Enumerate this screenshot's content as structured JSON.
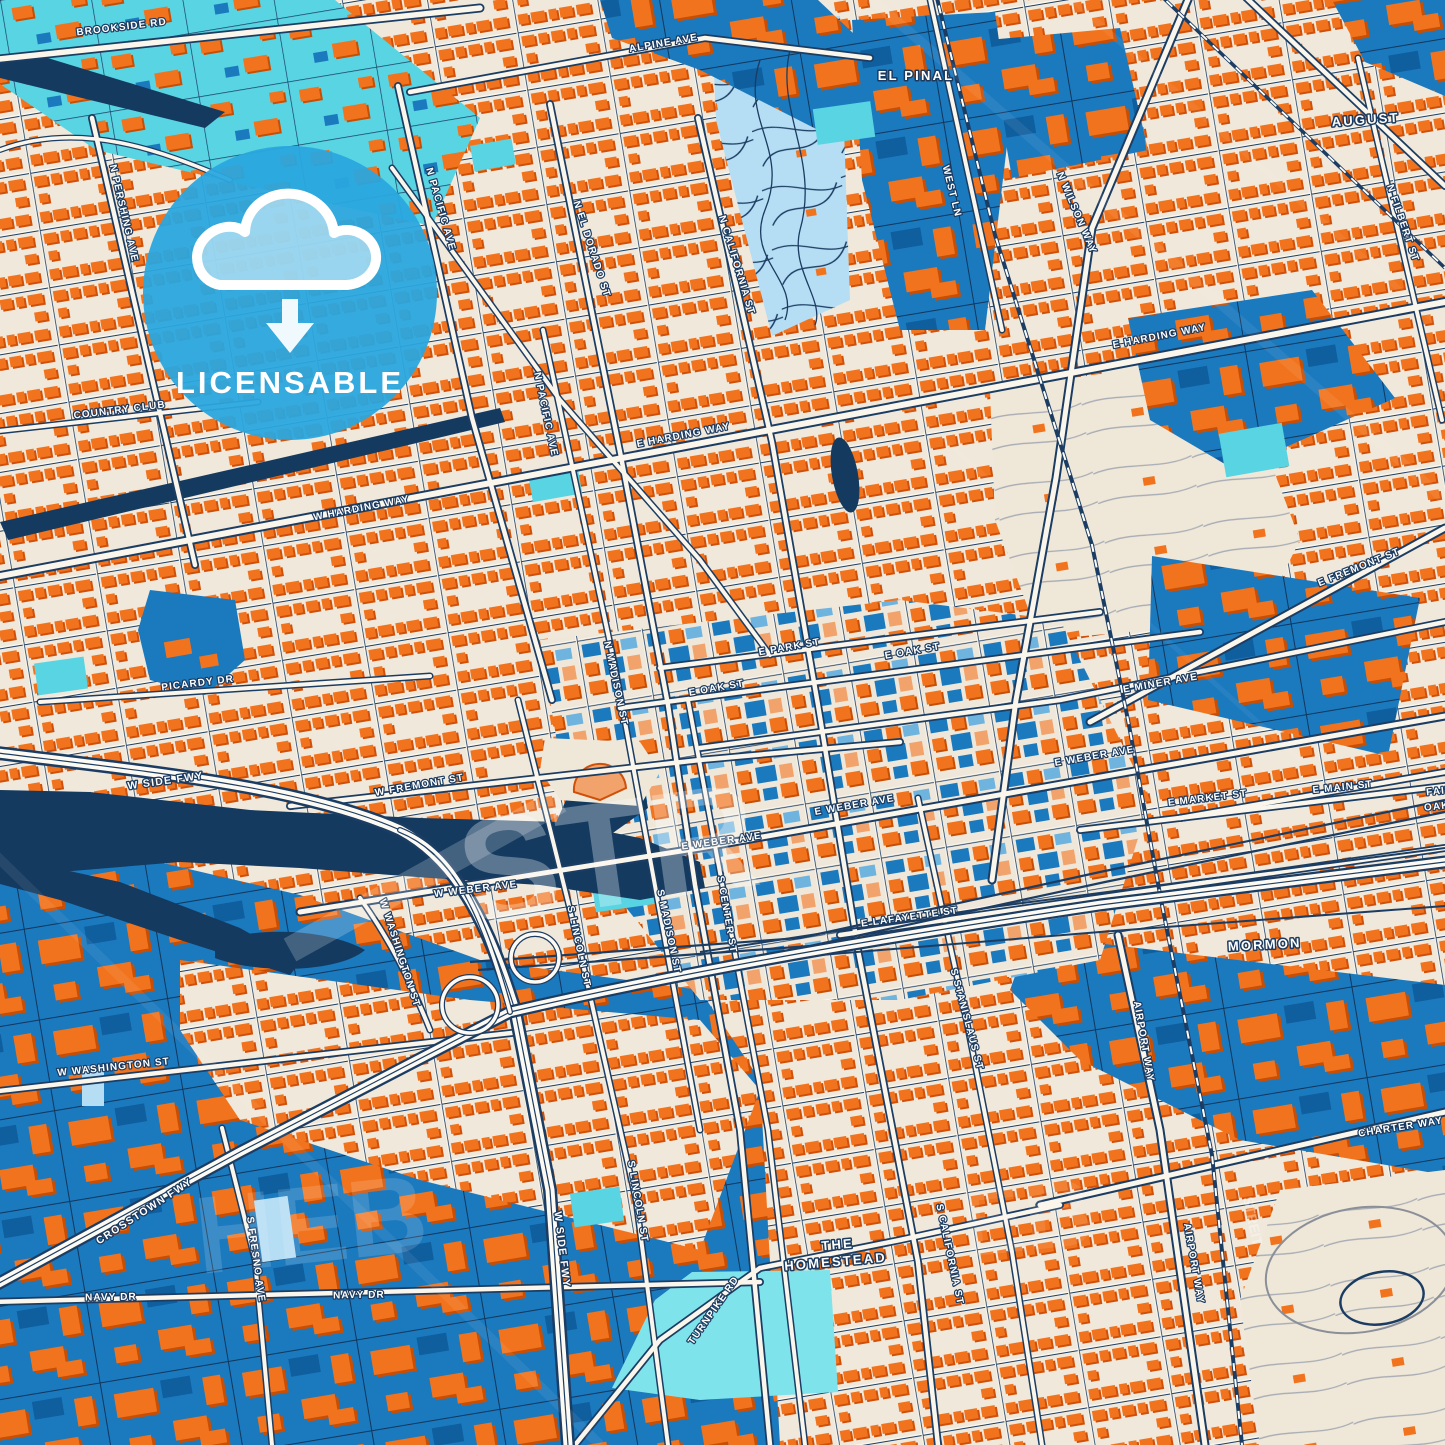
{
  "map": {
    "type": "stylized-city-map-poster",
    "city_hint": "Downtown street map with freeway, channel and rail yards",
    "badge": {
      "label": "LICENSABLE",
      "icon": "cloud-download-icon",
      "color": "#2AA7DE"
    },
    "colors": {
      "land": "#F0E8DA",
      "building_orange": "#F2731D",
      "building_shadow": "#D0500A",
      "building_salmon": "#F2A36B",
      "zone_blue": "#1B79BE",
      "zone_blue_dark": "#0F5E9E",
      "water_navy": "#143A60",
      "street_casing": "#1C3D63",
      "street_fill": "#FBF6EC",
      "park_cyan": "#58D4E2",
      "cemetery_lightblue": "#B5DDF4",
      "badge_blue": "#2AA7DE",
      "label_halo": "#1B3A5F",
      "label_fill": "#FFFFFF"
    },
    "labels": [
      {
        "text": "BROOKSIDE RD",
        "x": 122,
        "y": 30,
        "rot": -7,
        "kind": "street"
      },
      {
        "text": "ALPINE AVE",
        "x": 664,
        "y": 46,
        "rot": -10,
        "kind": "street"
      },
      {
        "text": "EL PINAL",
        "x": 916,
        "y": 80,
        "rot": 0,
        "kind": "locality"
      },
      {
        "text": "AUGUST",
        "x": 1366,
        "y": 124,
        "rot": -4,
        "kind": "locality"
      },
      {
        "text": "N PERSHING AVE",
        "x": 121,
        "y": 214,
        "rot": 77,
        "kind": "street"
      },
      {
        "text": "N PACIFIC AVE",
        "x": 438,
        "y": 210,
        "rot": 74,
        "kind": "street"
      },
      {
        "text": "N EL DORADO ST",
        "x": 589,
        "y": 250,
        "rot": 72,
        "kind": "street"
      },
      {
        "text": "N CALIFORNIA ST",
        "x": 734,
        "y": 266,
        "rot": 73,
        "kind": "street"
      },
      {
        "text": "WEST LN",
        "x": 949,
        "y": 192,
        "rot": 76,
        "kind": "street"
      },
      {
        "text": "N WILSON WAY",
        "x": 1074,
        "y": 214,
        "rot": 67,
        "kind": "street"
      },
      {
        "text": "N FILBERT ST",
        "x": 1400,
        "y": 224,
        "rot": 71,
        "kind": "street"
      },
      {
        "text": "E HARDING WAY",
        "x": 1160,
        "y": 339,
        "rot": -11,
        "kind": "street"
      },
      {
        "text": "COUNTRY CLUB",
        "x": 120,
        "y": 413,
        "rot": -7,
        "kind": "street"
      },
      {
        "text": "W HARDING WAY",
        "x": 362,
        "y": 511,
        "rot": -11,
        "kind": "street"
      },
      {
        "text": "E HARDING WAY",
        "x": 684,
        "y": 438,
        "rot": -11,
        "kind": "street"
      },
      {
        "text": "N PACIFIC AVE",
        "x": 543,
        "y": 415,
        "rot": 78,
        "kind": "street"
      },
      {
        "text": "E FREMONT ST",
        "x": 1360,
        "y": 570,
        "rot": -22,
        "kind": "street"
      },
      {
        "text": "E MINER AVE",
        "x": 1161,
        "y": 686,
        "rot": -10,
        "kind": "street"
      },
      {
        "text": "PICARDY DR",
        "x": 198,
        "y": 686,
        "rot": -7,
        "kind": "street"
      },
      {
        "text": "E PARK ST",
        "x": 790,
        "y": 650,
        "rot": -10,
        "kind": "street"
      },
      {
        "text": "E OAK ST",
        "x": 717,
        "y": 691,
        "rot": -10,
        "kind": "street"
      },
      {
        "text": "E OAK ST",
        "x": 913,
        "y": 654,
        "rot": -10,
        "kind": "street"
      },
      {
        "text": "N MADISON ST",
        "x": 613,
        "y": 684,
        "rot": 78,
        "kind": "street"
      },
      {
        "text": "W FREMONT ST",
        "x": 420,
        "y": 788,
        "rot": -10,
        "kind": "street"
      },
      {
        "text": "W SIDE FWY",
        "x": 166,
        "y": 784,
        "rot": -8,
        "kind": "fwy"
      },
      {
        "text": "E MAIN ST",
        "x": 1343,
        "y": 790,
        "rot": -6,
        "kind": "street"
      },
      {
        "text": "E MARKET ST",
        "x": 1208,
        "y": 801,
        "rot": -7,
        "kind": "street"
      },
      {
        "text": "FAIR",
        "x": 1440,
        "y": 794,
        "rot": -6,
        "kind": "street"
      },
      {
        "text": "OAKS",
        "x": 1441,
        "y": 809,
        "rot": -6,
        "kind": "street"
      },
      {
        "text": "E WEBER AVE",
        "x": 855,
        "y": 808,
        "rot": -10,
        "kind": "street"
      },
      {
        "text": "E WEBER AVE",
        "x": 1095,
        "y": 759,
        "rot": -10,
        "kind": "street"
      },
      {
        "text": "E WEBER AVE",
        "x": 722,
        "y": 844,
        "rot": -8,
        "kind": "street"
      },
      {
        "text": "W WEBER AVE",
        "x": 476,
        "y": 892,
        "rot": -7,
        "kind": "street"
      },
      {
        "text": "S LINCOLN ST",
        "x": 576,
        "y": 947,
        "rot": 78,
        "kind": "street"
      },
      {
        "text": "S MADISON ST",
        "x": 666,
        "y": 932,
        "rot": 78,
        "kind": "street"
      },
      {
        "text": "S CENTER ST",
        "x": 724,
        "y": 915,
        "rot": 80,
        "kind": "street"
      },
      {
        "text": "E LAFAYETTE ST",
        "x": 910,
        "y": 920,
        "rot": -8,
        "kind": "street"
      },
      {
        "text": "W WASHINGTON ST",
        "x": 397,
        "y": 954,
        "rot": 72,
        "kind": "street"
      },
      {
        "text": "S STANISLAUS ST",
        "x": 964,
        "y": 1020,
        "rot": 75,
        "kind": "street"
      },
      {
        "text": "W WASHINGTON ST",
        "x": 114,
        "y": 1070,
        "rot": -6,
        "kind": "street"
      },
      {
        "text": "MORMON",
        "x": 1265,
        "y": 949,
        "rot": -3,
        "kind": "locality"
      },
      {
        "text": "AIRPORT WAY",
        "x": 1141,
        "y": 1042,
        "rot": 80,
        "kind": "street"
      },
      {
        "text": "CHARTER WAY",
        "x": 1401,
        "y": 1130,
        "rot": -9,
        "kind": "street"
      },
      {
        "text": "CROSSTOWN FWY",
        "x": 146,
        "y": 1214,
        "rot": -33,
        "kind": "fwy"
      },
      {
        "text": "W SIDE FWY",
        "x": 559,
        "y": 1250,
        "rot": 83,
        "kind": "fwy"
      },
      {
        "text": "S LINCOLN ST",
        "x": 635,
        "y": 1202,
        "rot": 80,
        "kind": "street"
      },
      {
        "text": "S FRESNO AVE",
        "x": 253,
        "y": 1260,
        "rot": 82,
        "kind": "street"
      },
      {
        "text": "S CALIFORNIA ST",
        "x": 947,
        "y": 1255,
        "rot": 78,
        "kind": "street"
      },
      {
        "text": "TURNPIKE RD",
        "x": 716,
        "y": 1312,
        "rot": -55,
        "kind": "street"
      },
      {
        "text": "THE",
        "x": 838,
        "y": 1249,
        "rot": -5,
        "kind": "locality"
      },
      {
        "text": "HOMESTEAD",
        "x": 836,
        "y": 1266,
        "rot": -5,
        "kind": "locality"
      },
      {
        "text": "NAVY DR",
        "x": 111,
        "y": 1300,
        "rot": -1,
        "kind": "street"
      },
      {
        "text": "NAVY DR",
        "x": 359,
        "y": 1298,
        "rot": -1,
        "kind": "street"
      },
      {
        "text": "AIRPORT WAY",
        "x": 1191,
        "y": 1264,
        "rot": 80,
        "kind": "street"
      }
    ],
    "watermarks": [
      {
        "text": "STR",
        "x": 615,
        "y": 905,
        "rot": -8,
        "size": 150,
        "opacity": 0.3
      },
      {
        "text": "HEB",
        "x": 315,
        "y": 1262,
        "rot": -6,
        "size": 110,
        "opacity": 0.14
      },
      {
        "text": "EB",
        "x": 1030,
        "y": 1250,
        "rot": -6,
        "size": 95,
        "opacity": 0.1
      },
      {
        "text": "STREIT",
        "x": 1248,
        "y": 1222,
        "rot": 78,
        "size": 14,
        "opacity": 0.35
      }
    ]
  }
}
